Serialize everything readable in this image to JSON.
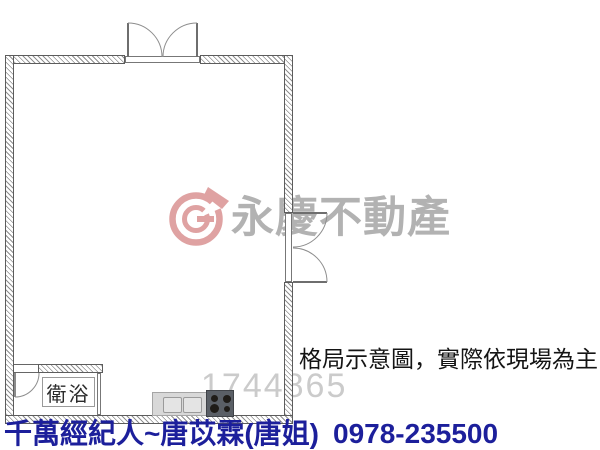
{
  "colors": {
    "wall_line": "#5c5c5c",
    "watermark_pink": "#dfa2a2",
    "watermark_gray": "#b2b2b2",
    "listing_number_gray": "#cbcbcb",
    "banner_blue": "#1c1f9b",
    "disclaimer_black": "#141414",
    "counter_gray": "#d8d8d8",
    "stove_dark": "#5a5f66"
  },
  "floorplan": {
    "bathroom_label": "衛浴",
    "disclaimer": "格局示意圖，實際依現場為主",
    "listing_number": "1744865",
    "watermark_brand": "永慶不動產"
  },
  "banner": {
    "agent_label": "千萬經紀人~唐苡霖(唐姐)",
    "phone": "0978-235500"
  }
}
